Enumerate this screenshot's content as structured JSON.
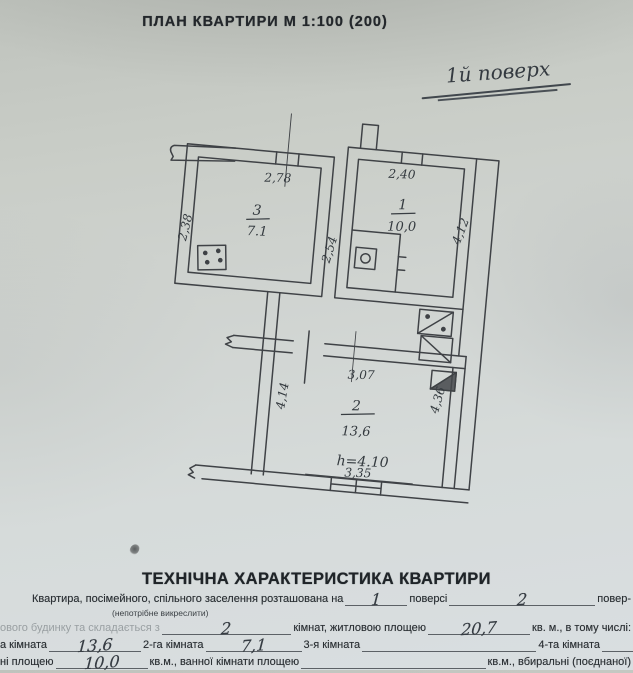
{
  "page_title": "ПЛАН КВАРТИРИ М 1:100 (200)",
  "floor_note": "1й поверх",
  "plan": {
    "room3": {
      "num": "3",
      "area": "7.1",
      "dim_top": "2,78",
      "dim_left": "2,38",
      "dim_right": "2,54"
    },
    "room1": {
      "num": "1",
      "area": "10,0",
      "dim_top": "2,40",
      "dim_right": "4,12"
    },
    "room2": {
      "num": "2",
      "area": "13,6",
      "height": "h=4.10",
      "dim_top": "3,07",
      "dim_left": "4,14",
      "dim_right": "4,36",
      "dim_bottom": "3,35"
    }
  },
  "tech": {
    "heading": "ТЕХНІЧНА ХАРАКТЕРИСТИКА КВАРТИРИ",
    "line1": {
      "pre": "Квартира, посімейного, спільного заселення розташована на",
      "val1": "1",
      "mid": "поверсі",
      "val2": "2",
      "end": "повер-",
      "note": "(непотрібне викреслити)"
    },
    "line2": {
      "pre": "ового будинку та складається з",
      "val1": "2",
      "mid": "кімнат, житловою площею",
      "val2": "20,7",
      "end": "кв. м., в тому числі:"
    },
    "line3": {
      "pre": "а кімната",
      "val1": "13,6",
      "mid1": "2-га кімната",
      "val2": "7,1",
      "mid2": "3-я кімната",
      "mid3": "4-та кімната"
    },
    "line4": {
      "pre": "ні площею",
      "val1": "10,0",
      "mid": "кв.м., ванної кімнати площею",
      "end": "кв.м., вбиральні (поєднаної)"
    }
  }
}
